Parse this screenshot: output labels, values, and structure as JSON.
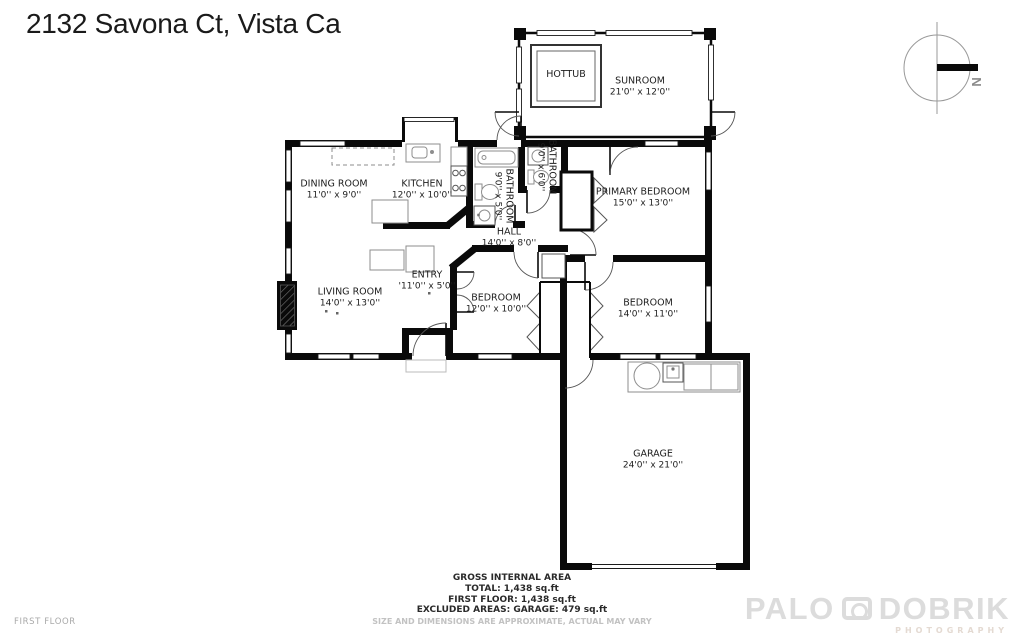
{
  "title": "2132 Savona Ct, Vista Ca",
  "compass": {
    "north_label": "N"
  },
  "rooms": {
    "hottub": {
      "name": "HOTTUB",
      "dims": ""
    },
    "sunroom": {
      "name": "SUNROOM",
      "dims": "21'0'' x 12'0''"
    },
    "dining": {
      "name": "DINING ROOM",
      "dims": "11'0'' x 9'0''"
    },
    "kitchen": {
      "name": "KITCHEN",
      "dims": "12'0'' x 10'0''"
    },
    "bathroom1": {
      "name": "BATHROOM",
      "dims": "9'0'' x 5'0''"
    },
    "bathroom2": {
      "name": "BATHROOM",
      "dims": "9'0'' x 6'0''"
    },
    "primary": {
      "name": "PRIMARY BEDROOM",
      "dims": "15'0'' x 13'0''"
    },
    "hall": {
      "name": "HALL",
      "dims": "14'0'' x 8'0''"
    },
    "entry": {
      "name": "ENTRY",
      "dims": "'11'0'' x 5'0''"
    },
    "living": {
      "name": "LIVING ROOM",
      "dims": "14'0'' x 13'0''"
    },
    "bedroom1": {
      "name": "BEDROOM",
      "dims": "12'0'' x 10'0''"
    },
    "bedroom2": {
      "name": "BEDROOM",
      "dims": "14'0'' x 11'0''"
    },
    "garage": {
      "name": "GARAGE",
      "dims": "24'0'' x 21'0''"
    }
  },
  "footer": {
    "heading": "GROSS INTERNAL AREA",
    "total": "TOTAL: 1,438 sq.ft",
    "first_floor": "FIRST FLOOR: 1,438 sq.ft",
    "excluded": "EXCLUDED AREAS: GARAGE: 479 sq.ft",
    "disclaimer": "SIZE AND DIMENSIONS ARE APPROXIMATE, ACTUAL MAY VARY"
  },
  "floor_label": "FIRST FLOOR",
  "watermark": {
    "line1_a": "PALO",
    "line1_b": "DOBRIK",
    "line2": "PHOTOGRAPHY"
  },
  "colors": {
    "wall": "#0a0a0a",
    "fixture": "#8e8e8e",
    "text": "#1d1d1d",
    "muted": "#c2c2c2",
    "watermark": "#dcdcdc"
  }
}
